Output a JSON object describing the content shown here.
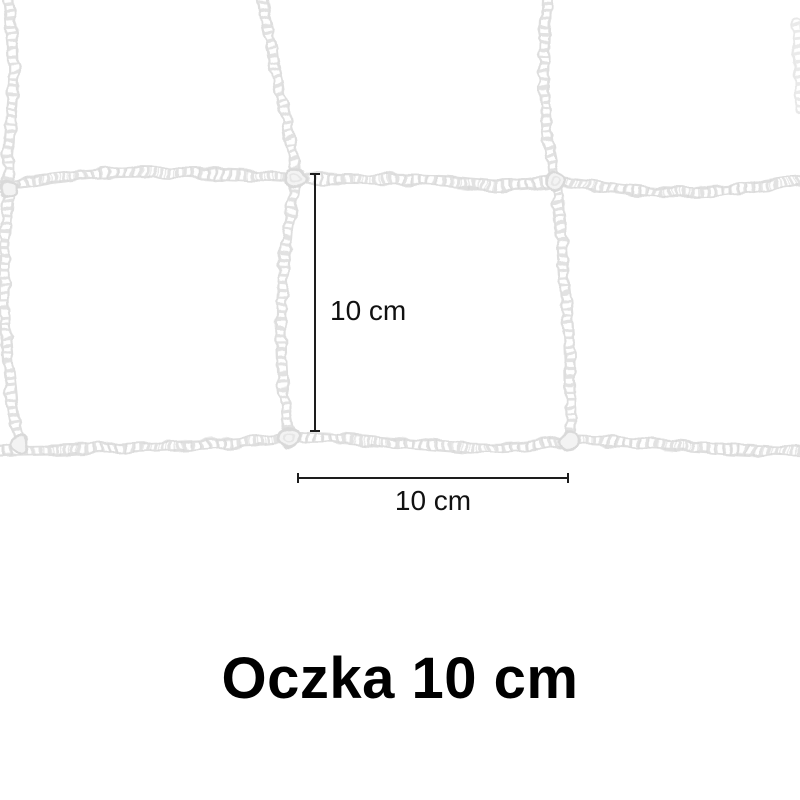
{
  "image": {
    "kind": "product-photo-with-dimension-annotations",
    "background_color": "#ffffff"
  },
  "net": {
    "description": "white braided sport net mesh, two rows of square meshes",
    "rope_edge_color": "#dedede",
    "rope_core_color": "#ffffff",
    "mesh_size_cm": 10
  },
  "dimensions": {
    "vertical": {
      "label": "10 cm"
    },
    "horizontal": {
      "label": "10 cm"
    },
    "line_color": "#1d1d1d",
    "label_color": "#111111"
  },
  "caption": {
    "title": "Oczka 10 cm",
    "color": "#000000"
  }
}
